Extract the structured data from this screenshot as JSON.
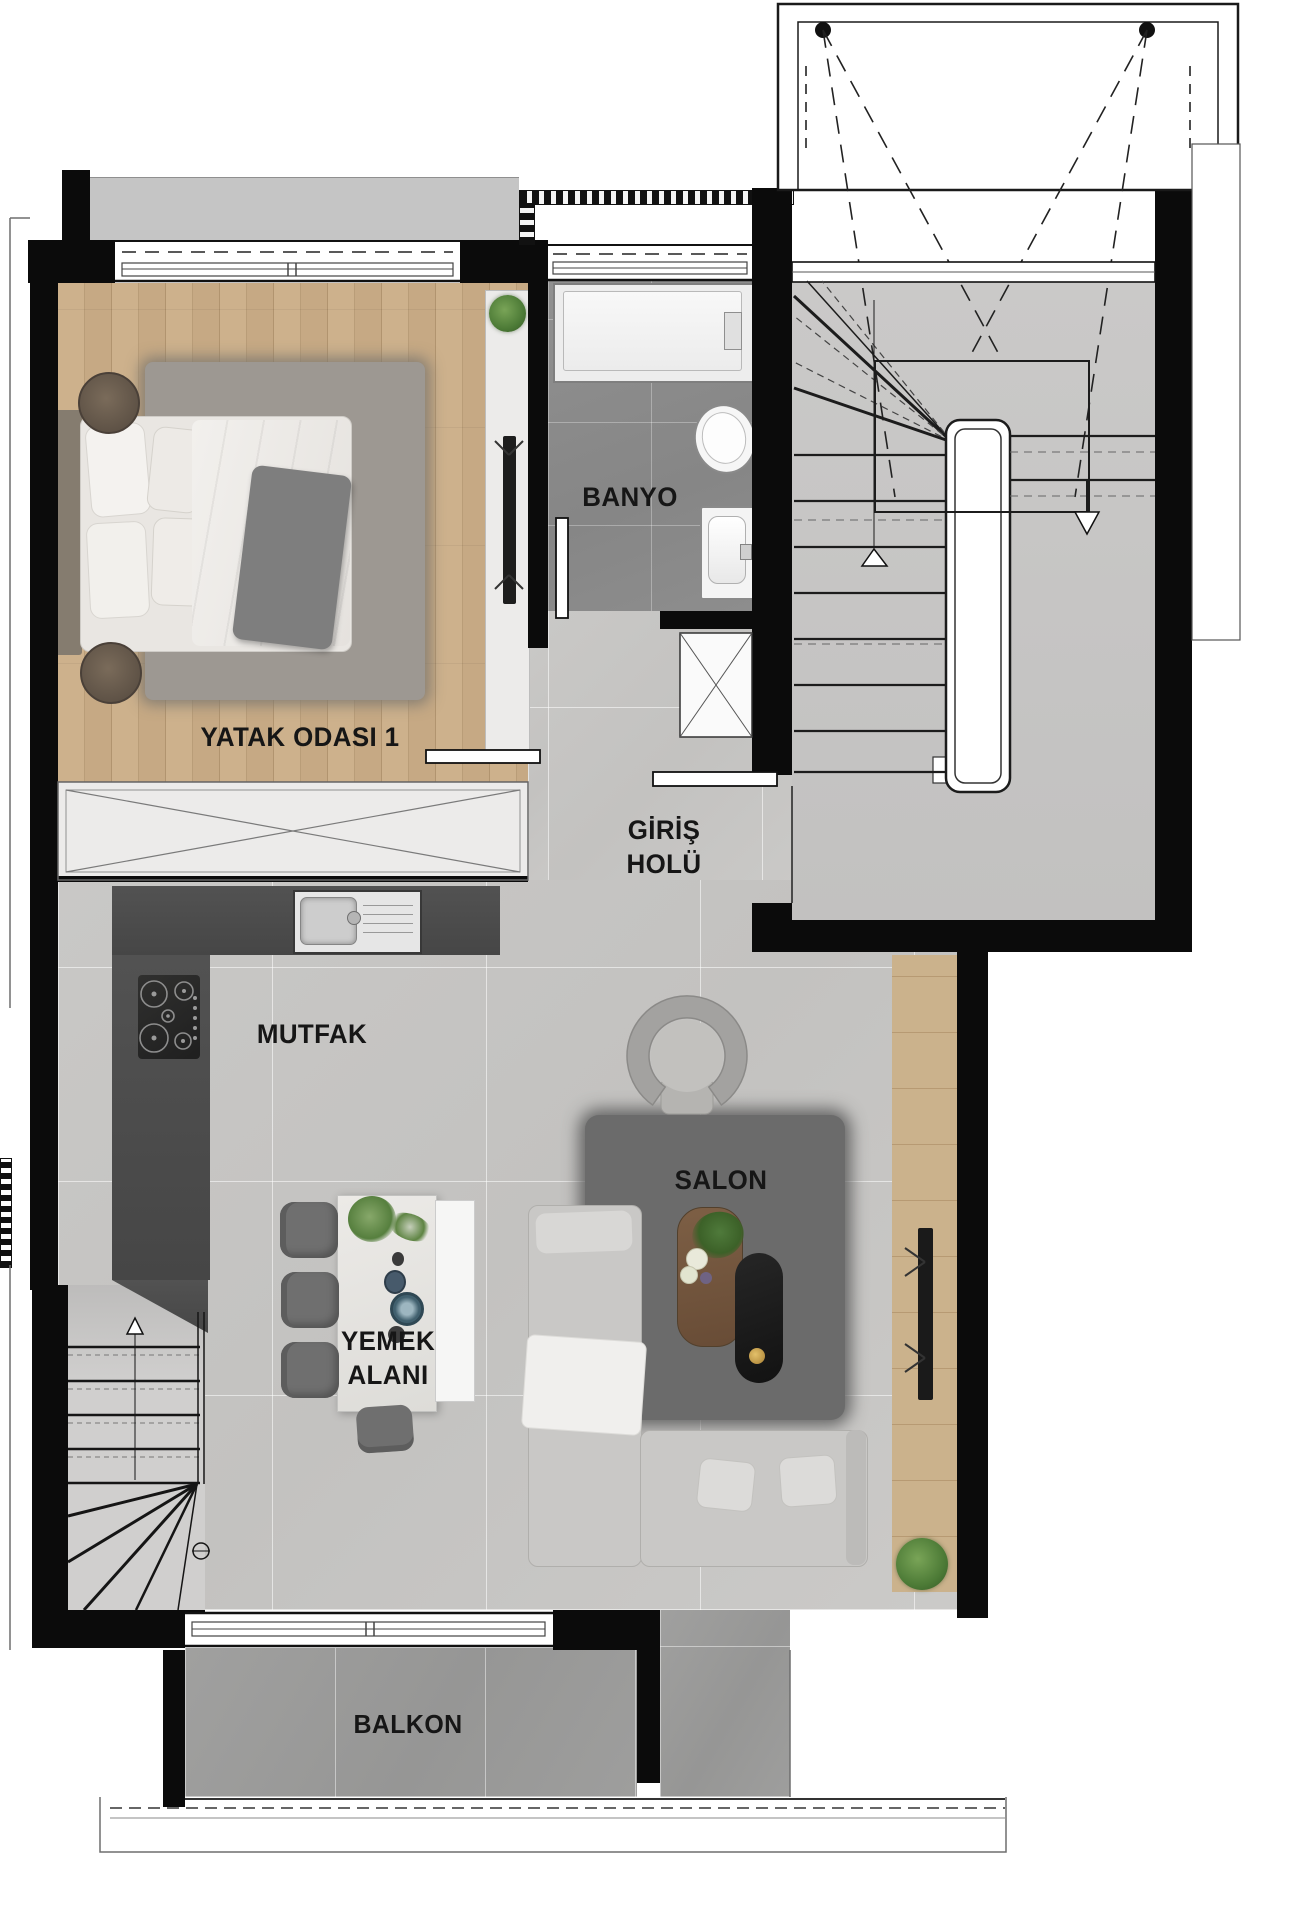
{
  "rooms": {
    "bedroom": {
      "label": "YATAK ODASI 1"
    },
    "bathroom": {
      "label": "BANYO"
    },
    "entry_hall": {
      "label_line1": "GİRİŞ",
      "label_line2": "HOLÜ"
    },
    "kitchen": {
      "label": "MUTFAK"
    },
    "living_room": {
      "label": "SALON"
    },
    "dining_area": {
      "label_line1": "YEMEK",
      "label_line2": "ALANI"
    },
    "balcony": {
      "label": "BALKON"
    }
  },
  "colors": {
    "walls": "#0b0b0b",
    "bedroom_wood_floor": "#c6a984",
    "living_tile_floor": "#c7c6c4",
    "bathroom_tile_floor": "#8c8c8c",
    "balcony_tile_floor": "#9b9b9a",
    "stair_floor": "#c6c6c6",
    "kitchen_counter": "#4d4d4d",
    "living_rug": "#6b6b6b",
    "bedroom_rug": "#9d9892",
    "plant_green": "#4d7a39",
    "label_text": "#161616"
  }
}
